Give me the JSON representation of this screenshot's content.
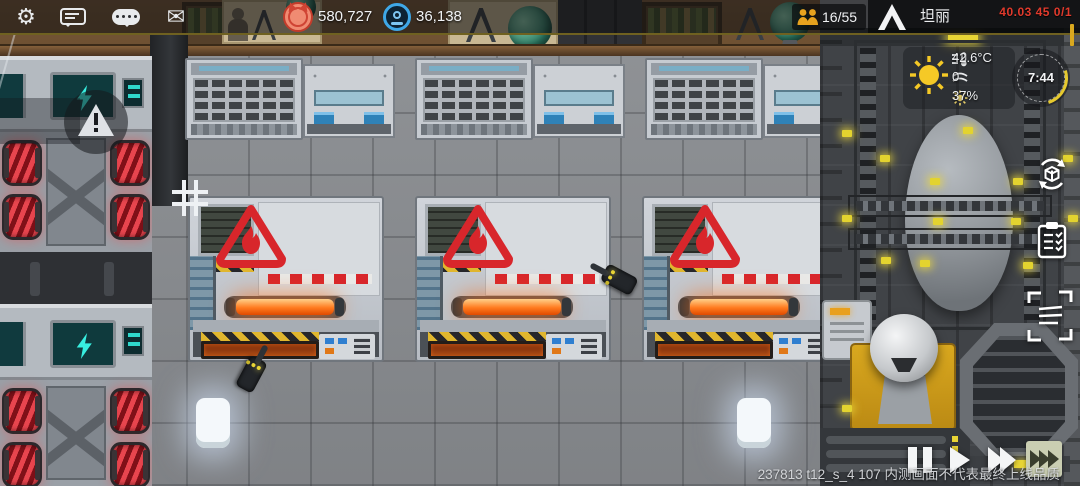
{
  "topbar": {
    "icons": [
      "settings-gear",
      "chat-bubble",
      "sms-bubble",
      "mail-envelope"
    ],
    "resources": [
      {
        "icon": "red-creature-coin",
        "value": "580,727"
      },
      {
        "icon": "blue-badge-coin",
        "value": "36,138"
      }
    ],
    "population": {
      "icon": "people-icon",
      "value": "16/55"
    },
    "logo": "A-peak-logo",
    "colony_name": "坦丽",
    "debug_readout": "40.03 45 0/1"
  },
  "weather": {
    "temperature": "42.6°C",
    "wind": "0",
    "humidity": "37%",
    "clock_time": "7:44"
  },
  "side_icons": [
    "rotate-view-icon",
    "task-list-icon",
    "selection-brackets-icon"
  ],
  "playback": {
    "buttons": [
      "pause",
      "play",
      "fast-forward-2x",
      "fast-forward-3x"
    ],
    "active": "fast-forward-3x"
  },
  "footer": {
    "build_text": "237813 t12_s_4 107 内测画面不代表最终上线品质"
  },
  "hud_colors": {
    "accent_yellow": "#e6c92e",
    "alert_red": "#e03a2c",
    "glow_orange": "#ff7a20",
    "screen_cyan": "#2ee6d6",
    "coil_red": "#e04048"
  },
  "scene_objects": {
    "hazard_furnaces": 3,
    "storage_machines": 3,
    "generator_units": 4,
    "floor_lights": 2,
    "worker_drones": 2,
    "alerts": [
      "warning-triangle-bubble"
    ],
    "hazard_sign": "flame-warning"
  }
}
